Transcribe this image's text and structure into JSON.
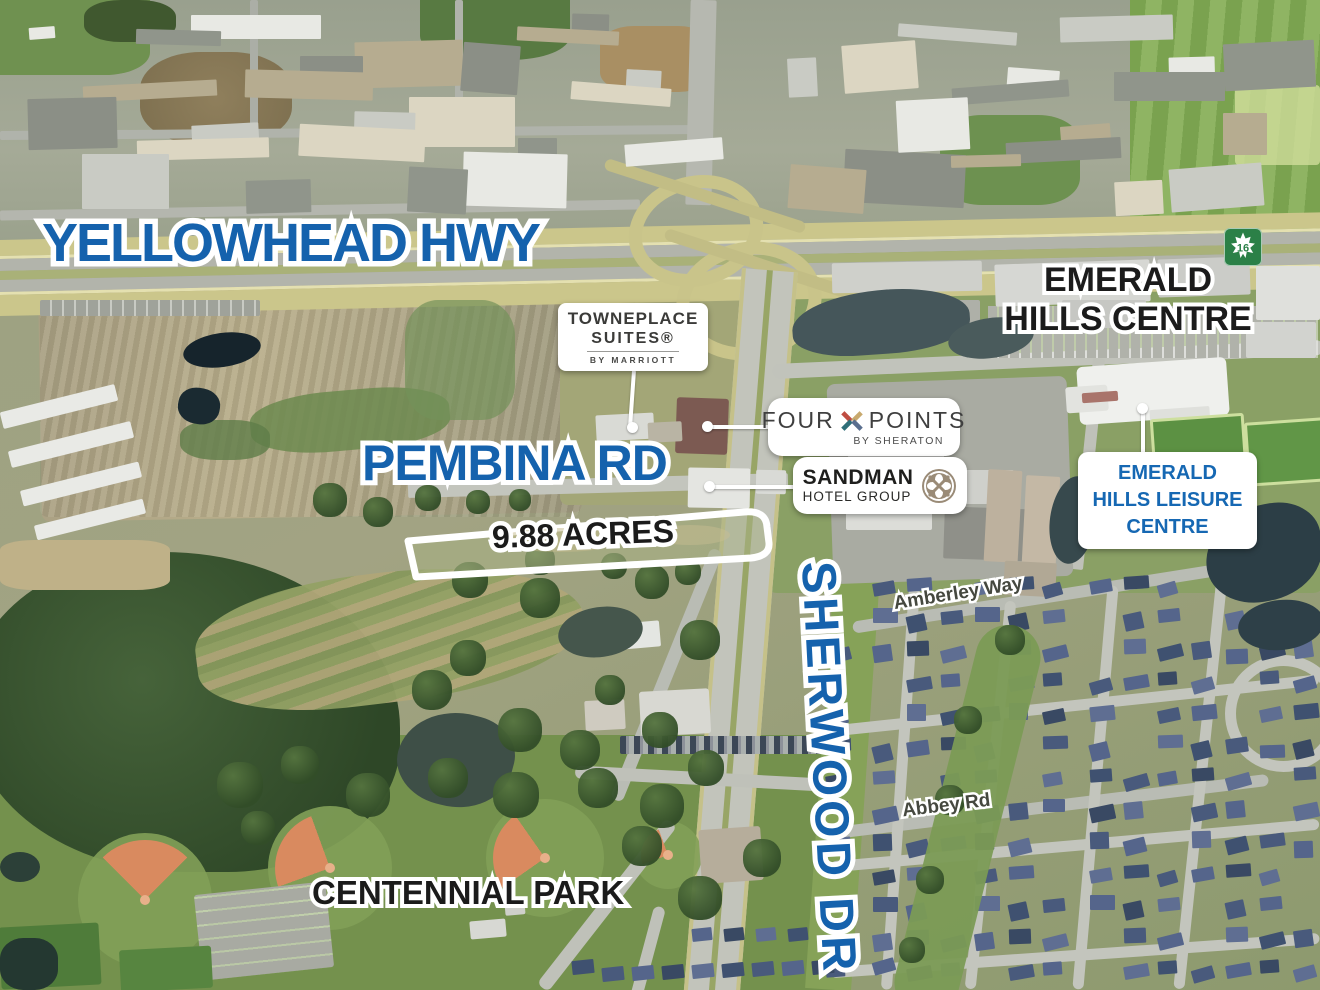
{
  "title": "Aerial land-for-sale map — 9.88 acres, Sherwood Park",
  "colors": {
    "label_blue": "#1562ad",
    "label_black": "#1b1b1b",
    "street_label": "#45483f",
    "leisure_blue": "#1668b3",
    "shield_green": "#2b8047",
    "parcel_outline": "#ffffff",
    "fp_red": "#bf4d42",
    "fp_teal": "#2f6f79",
    "fp_gold": "#c8a96e",
    "fp_slate": "#5a6e8e",
    "sandman_taupe": "#9a8b77"
  },
  "map_labels": {
    "highway": "YELLOWHEAD HWY",
    "pembina": "PEMBINA RD",
    "sherwood": "SHERWOOD DR",
    "parcel": "9.88 ACRES",
    "park": "CENTENNIAL PARK",
    "centre_line1": "EMERALD",
    "centre_line2": "HILLS CENTRE",
    "amberley": "Amberley Way",
    "abbey": "Abbey Rd",
    "shield": "16"
  },
  "callouts": {
    "towneplace": {
      "brand": "TOWNEPLACE",
      "sub": "SUITES®",
      "tagline": "BY MARRIOTT"
    },
    "fourpoints": {
      "word1": "FOUR",
      "word2": "POINTS",
      "tagline": "BY SHERATON"
    },
    "sandman": {
      "brand": "SANDMAN",
      "sub": "HOTEL GROUP"
    },
    "leisure": {
      "line1": "EMERALD",
      "line2": "HILLS LEISURE",
      "line3": "CENTRE"
    }
  }
}
